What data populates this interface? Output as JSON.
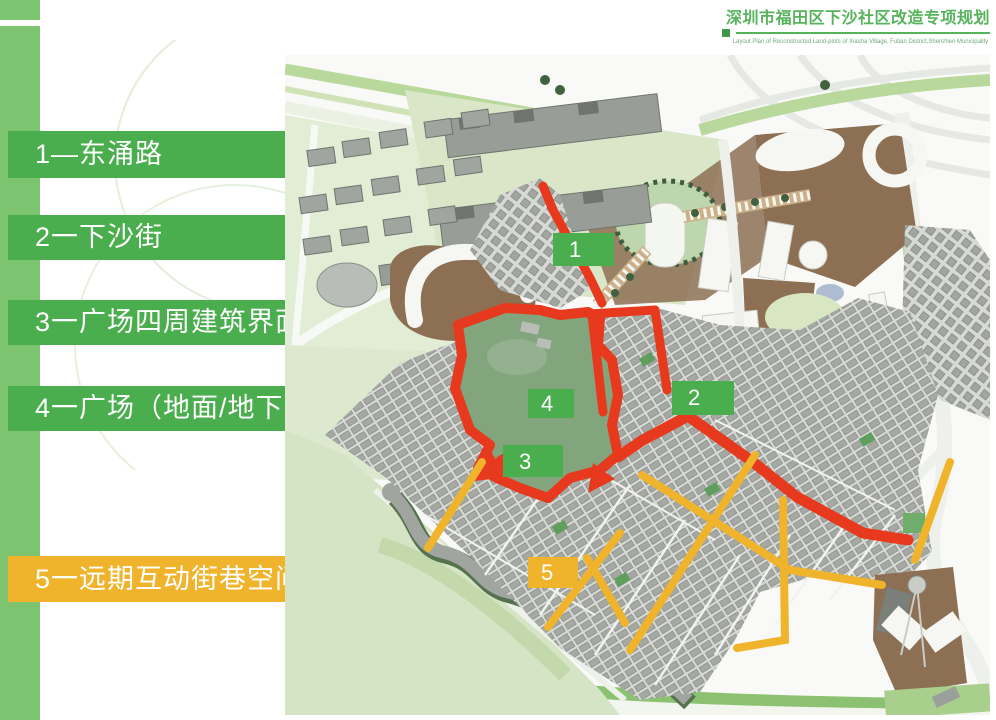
{
  "header": {
    "title": "深圳市福田区下沙社区改造专项规划",
    "subtitle": "Layout Plan of Reconstructed Land-plots of Xiasha Village, Futian District,Shenzhen Municipality",
    "accent_color": "#56b35c"
  },
  "legend": {
    "items": [
      {
        "id": "1",
        "label": "1—东涌路",
        "color": "#4aad4e",
        "text_color": "#ffffff"
      },
      {
        "id": "2",
        "label": "2一下沙街",
        "color": "#4aad4e",
        "text_color": "#ffffff"
      },
      {
        "id": "3",
        "label": "3一广场四周建筑界面",
        "color": "#4aad4e",
        "text_color": "#ffffff"
      },
      {
        "id": "4",
        "label": "4一广场（地面/地下）",
        "color": "#4aad4e",
        "text_color": "#ffffff"
      },
      {
        "id": "5",
        "label": "5一远期互动街巷空间",
        "color": "#f0b42c",
        "text_color": "#ffffff"
      }
    ]
  },
  "map": {
    "markers": [
      {
        "label": "1",
        "color": "#4aad4e"
      },
      {
        "label": "2",
        "color": "#4aad4e"
      },
      {
        "label": "3",
        "color": "#4aad4e"
      },
      {
        "label": "4",
        "color": "#4aad4e"
      },
      {
        "label": "5",
        "color": "#f0b42c"
      }
    ],
    "colors": {
      "highlight_route_red": "#e6391d",
      "future_street_yellow": "#f0b42c",
      "plaza_green": "#82a57e",
      "park_green": "#d5e4c4",
      "brown_plaza": "#8d6f53",
      "building_gray": "#a5a8a3",
      "sidebar_green": "#7cc46f"
    }
  }
}
